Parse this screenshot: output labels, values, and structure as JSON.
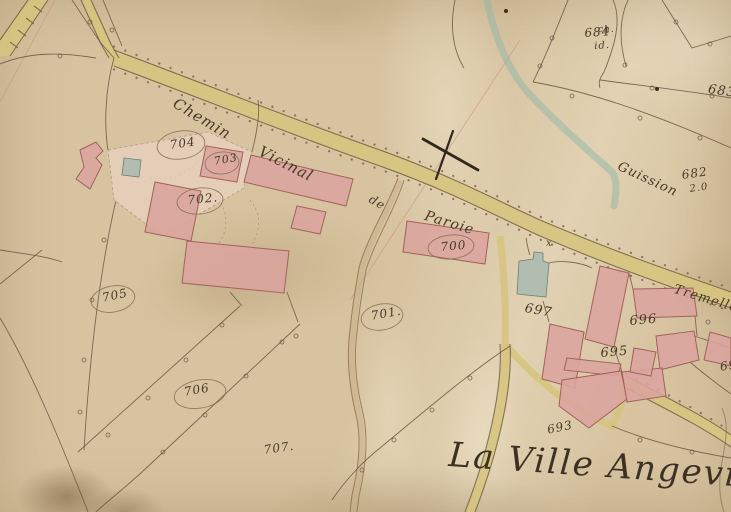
{
  "map": {
    "style": "cadastral-plan",
    "hamlet_label": "La Ville Angevin.",
    "road_labels": {
      "chemin": "Chemin",
      "vicinal": "Vicinal",
      "de": "de",
      "paroie": "Paroie"
    },
    "place_labels": {
      "guission": "Guission",
      "tremelle": "Tremelle"
    },
    "annotations": {
      "note_684": "id.",
      "note_682": "2.0",
      "note_ch": "ch.",
      "mark_x": "x",
      "partial_694": "69"
    },
    "parcel_numbers": {
      "p684": "684",
      "p683": "683",
      "p682": "682",
      "p704": "704",
      "p703": "703",
      "p702": "702.",
      "p700": "700",
      "p705": "705",
      "p701": "701.",
      "p697": "697",
      "p696": "696",
      "p695": "695",
      "p706": "706",
      "p707": "707.",
      "p693": "693"
    },
    "colors": {
      "paper": "#d7c3a0",
      "road": "#d6c47e",
      "building": "#dba49e",
      "building_outline": "#a2625a",
      "water": "#8fb5a9",
      "ink": "#473a28"
    }
  }
}
